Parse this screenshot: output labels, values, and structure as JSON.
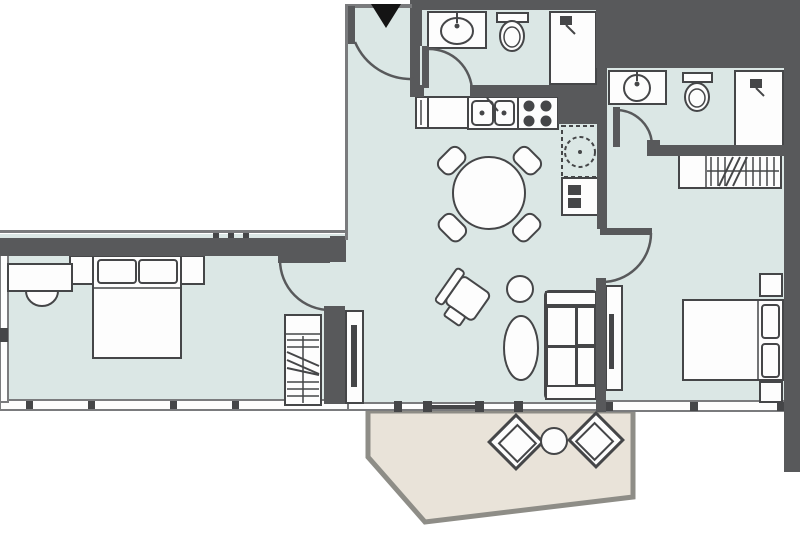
{
  "type": "floor-plan",
  "colors": {
    "floor": "#dbe7e5",
    "wall": "#58595b",
    "thinwall": "#7a7b7d",
    "line": "#454648",
    "fixture": "#fdfdfd",
    "balcony_floor": "#e9e3d9",
    "balcony_border": "#8e8d87",
    "exterior": "#ffffff",
    "marker": "#141414"
  },
  "marker": {
    "name": "entrance-direction-triangle"
  },
  "rooms": [
    {
      "name": "entry-hall",
      "features": [
        "entrance-door"
      ]
    },
    {
      "name": "bathroom-1",
      "features": [
        "sink-vanity",
        "toilet",
        "shower"
      ]
    },
    {
      "name": "kitchen",
      "features": [
        "counter",
        "double-sink",
        "cooktop-4-burner",
        "washing-machine",
        "oven-stack"
      ]
    },
    {
      "name": "living-dining-room",
      "features": [
        "round-dining-table",
        "four-dining-chairs",
        "armchair",
        "side-table",
        "coffee-table",
        "sofa",
        "tv-console",
        "sliding-balcony-door"
      ]
    },
    {
      "name": "bedroom-1",
      "features": [
        "double-bed",
        "two-nightstands",
        "desk",
        "desk-chair",
        "wardrobe",
        "window"
      ]
    },
    {
      "name": "bedroom-2",
      "features": [
        "double-bed",
        "two-nightstands",
        "tv-console",
        "wardrobe",
        "window"
      ]
    },
    {
      "name": "bathroom-2",
      "features": [
        "sink-vanity",
        "toilet",
        "shower"
      ]
    },
    {
      "name": "balcony",
      "features": [
        "two-outdoor-chairs",
        "round-table"
      ]
    }
  ]
}
